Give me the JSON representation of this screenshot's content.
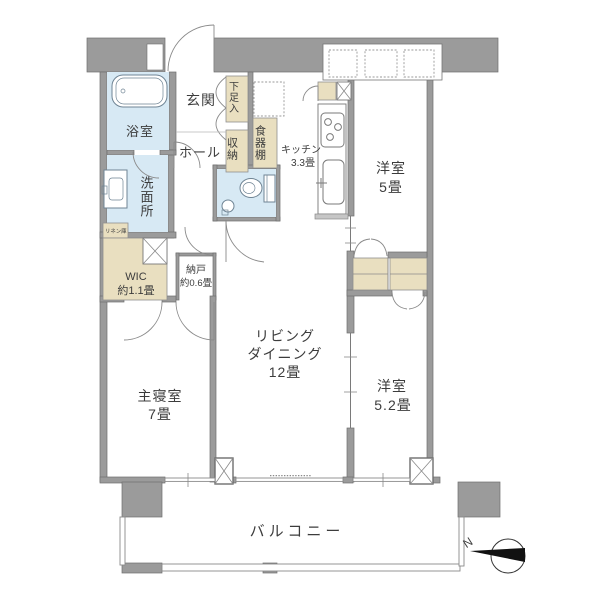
{
  "plan": {
    "colors": {
      "wall": "#9b9b9b",
      "wet": "#d7e9f4",
      "tan": "#e9dfc0",
      "line": "#707070",
      "needle": "#111111"
    },
    "rooms": {
      "entrance": {
        "label": "玄関"
      },
      "hall": {
        "label": "ホール"
      },
      "bathroom": {
        "label": "浴室"
      },
      "washroom": {
        "label": "洗面所"
      },
      "linen": {
        "label": "リネン庫"
      },
      "shoe_cabinet": {
        "label": "下足入"
      },
      "storage": {
        "label": "収納"
      },
      "cupboard": {
        "label": "食器棚"
      },
      "kitchen": {
        "line1": "キッチン",
        "line2": "3.3畳"
      },
      "western5": {
        "line1": "洋室",
        "line2": "5畳"
      },
      "western52": {
        "line1": "洋室",
        "line2": "5.2畳"
      },
      "living": {
        "line1": "リビング",
        "line2": "ダイニング",
        "line3": "12畳"
      },
      "master": {
        "line1": "主寝室",
        "line2": "7畳"
      },
      "wic": {
        "line1": "WIC",
        "line2": "約1.1畳"
      },
      "nando": {
        "line1": "納戸",
        "line2": "約0.6畳"
      },
      "balcony": {
        "label": "バルコニー"
      }
    },
    "compass": {
      "north_label": "N"
    }
  }
}
